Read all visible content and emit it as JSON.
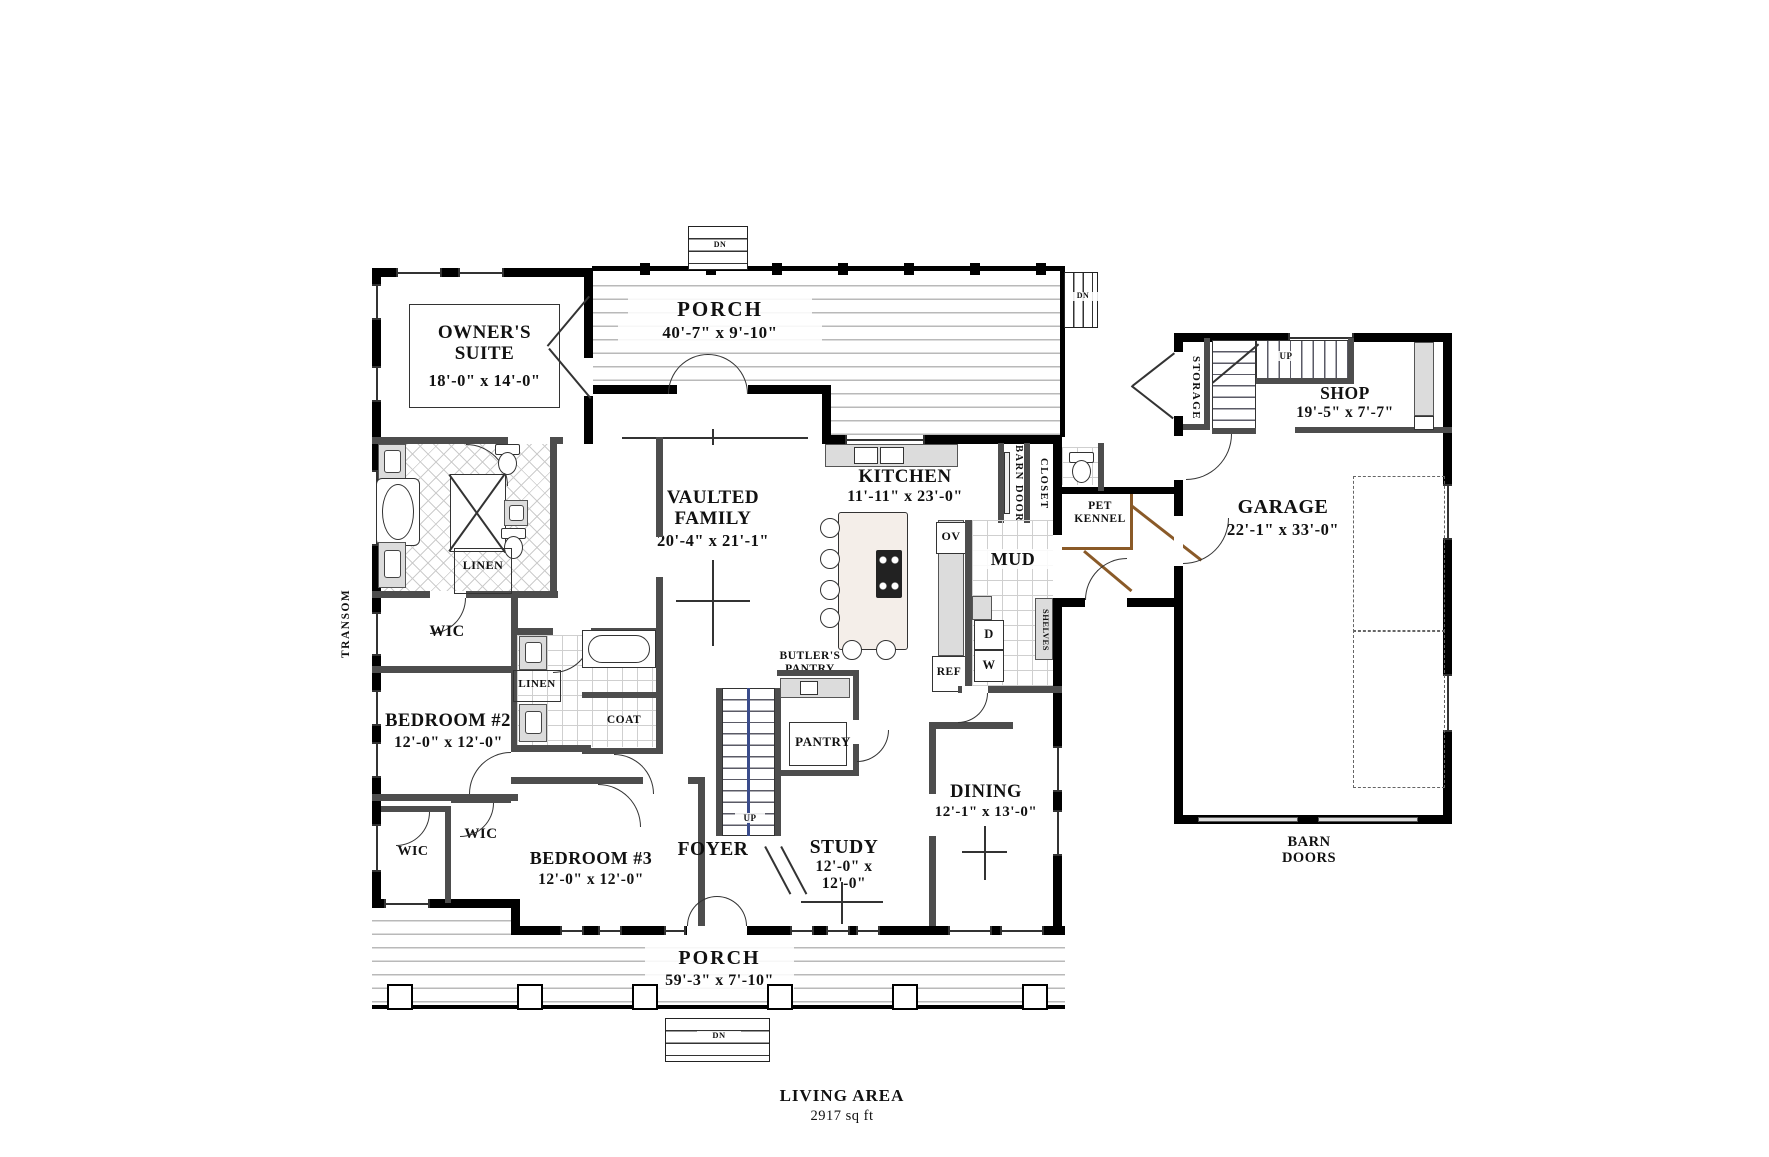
{
  "rooms": {
    "porch_top": {
      "name": "PORCH",
      "dim": "40'-7\" x 9'-10\""
    },
    "owners_suite": {
      "name": "OWNER'S SUITE",
      "dim": "18'-0\" x 14'-0\""
    },
    "family": {
      "name": "VAULTED FAMILY",
      "dim": "20'-4\" x 21'-1\""
    },
    "kitchen": {
      "name": "KITCHEN",
      "dim": "11'-11\" x 23'-0\""
    },
    "mud": {
      "name": "MUD"
    },
    "pet_kennel": {
      "name": "PET KENNEL"
    },
    "closet": {
      "name": "CLOSET"
    },
    "barn_door": {
      "name": "BARN DOOR"
    },
    "storage": {
      "name": "STORAGE"
    },
    "shop": {
      "name": "SHOP",
      "dim": "19'-5\" x 7'-7\""
    },
    "garage": {
      "name": "GARAGE",
      "dim": "22'-1\" x 33'-0\""
    },
    "barn_doors": {
      "name": "BARN DOORS"
    },
    "wic_owner": {
      "name": "WIC"
    },
    "linen_owner": {
      "name": "LINEN"
    },
    "bedroom2": {
      "name": "BEDROOM #2",
      "dim": "12'-0\" x 12'-0\""
    },
    "linen_hall": {
      "name": "LINEN"
    },
    "coat": {
      "name": "COAT"
    },
    "wic_a": {
      "name": "WIC"
    },
    "wic_b": {
      "name": "WIC"
    },
    "bedroom3": {
      "name": "BEDROOM #3",
      "dim": "12'-0\" x 12'-0\""
    },
    "foyer": {
      "name": "FOYER"
    },
    "study": {
      "name": "STUDY",
      "dim": "12'-0\" x 12'-0\""
    },
    "dining": {
      "name": "DINING",
      "dim": "12'-1\" x 13'-0\""
    },
    "pantry": {
      "name": "PANTRY"
    },
    "butlers_pantry": {
      "name": "BUTLER'S PANTRY"
    },
    "porch_bottom": {
      "name": "PORCH",
      "dim": "59'-3\" x 7'-10\""
    },
    "shelves": {
      "name": "SHELVES"
    },
    "transom": {
      "name": "TRANSOM"
    }
  },
  "appliances": {
    "oven": "OV",
    "dryer": "D",
    "washer": "W",
    "fridge": "REF"
  },
  "stairs": {
    "up_main": "UP",
    "up_garage": "UP",
    "down_top": "DN",
    "down_side": "DN",
    "down_bottom": "DN"
  },
  "footer": {
    "living_area_label": "LIVING AREA",
    "living_area_value": "2917 sq ft"
  },
  "colors": {
    "exterior_wall": "#000000",
    "interior_wall": "#4d4d4d",
    "kennel_brown": "#8a5a28",
    "stair_rail_blue": "#3a4c8c",
    "counter_gray": "#dcdcdc"
  }
}
